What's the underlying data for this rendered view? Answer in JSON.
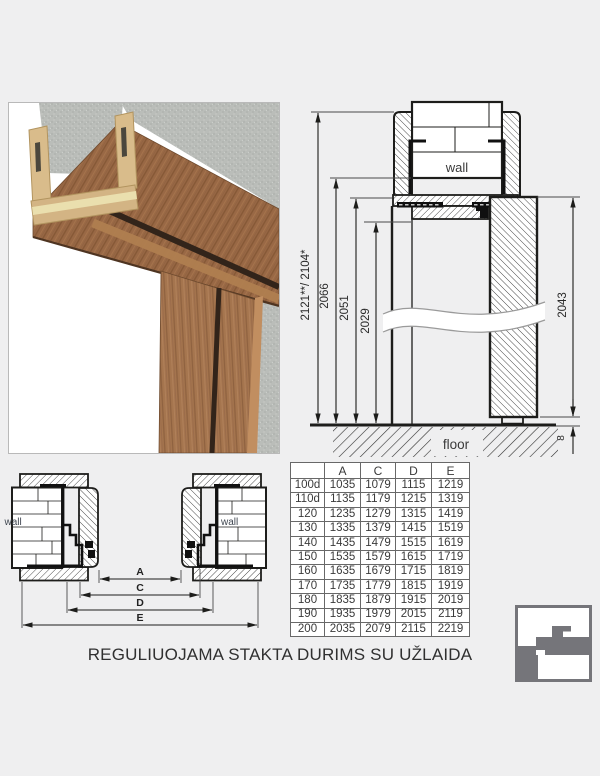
{
  "title": "REGULIUOJAMA STAKTA DURIMS SU UŽLAIDA",
  "vertical_section": {
    "wall_label": "wall",
    "floor_label": "floor",
    "dim_total": "2121**/ 2104*",
    "dim_2066": "2066",
    "dim_2051": "2051",
    "dim_2029": "2029",
    "dim_leaf": "2043",
    "dim_gap": "8"
  },
  "plan_section": {
    "wall_left_label": "wall",
    "wall_right_label": "wall",
    "dim_a": "A",
    "dim_c": "C",
    "dim_d": "D",
    "dim_e": "E"
  },
  "table": {
    "headers": [
      "",
      "A",
      "C",
      "D",
      "E"
    ],
    "rows": [
      [
        "100d",
        "1035",
        "1079",
        "1115",
        "1219"
      ],
      [
        "110d",
        "1135",
        "1179",
        "1215",
        "1319"
      ],
      [
        "120",
        "1235",
        "1279",
        "1315",
        "1419"
      ],
      [
        "130",
        "1335",
        "1379",
        "1415",
        "1519"
      ],
      [
        "140",
        "1435",
        "1479",
        "1515",
        "1619"
      ],
      [
        "150",
        "1535",
        "1579",
        "1615",
        "1719"
      ],
      [
        "160",
        "1635",
        "1679",
        "1715",
        "1819"
      ],
      [
        "170",
        "1735",
        "1779",
        "1815",
        "1919"
      ],
      [
        "180",
        "1835",
        "1879",
        "1915",
        "2019"
      ],
      [
        "190",
        "1935",
        "1979",
        "2015",
        "2119"
      ],
      [
        "200",
        "2035",
        "2079",
        "2115",
        "2219"
      ]
    ]
  },
  "logo": {
    "icon": "door-frame-profile-icon"
  },
  "colors": {
    "background": "#efeff0",
    "line": "#1d1d1b",
    "wood": "#996845",
    "concrete": "#babdb9",
    "logo_gray": "#75757a",
    "table_border": "#686868"
  }
}
